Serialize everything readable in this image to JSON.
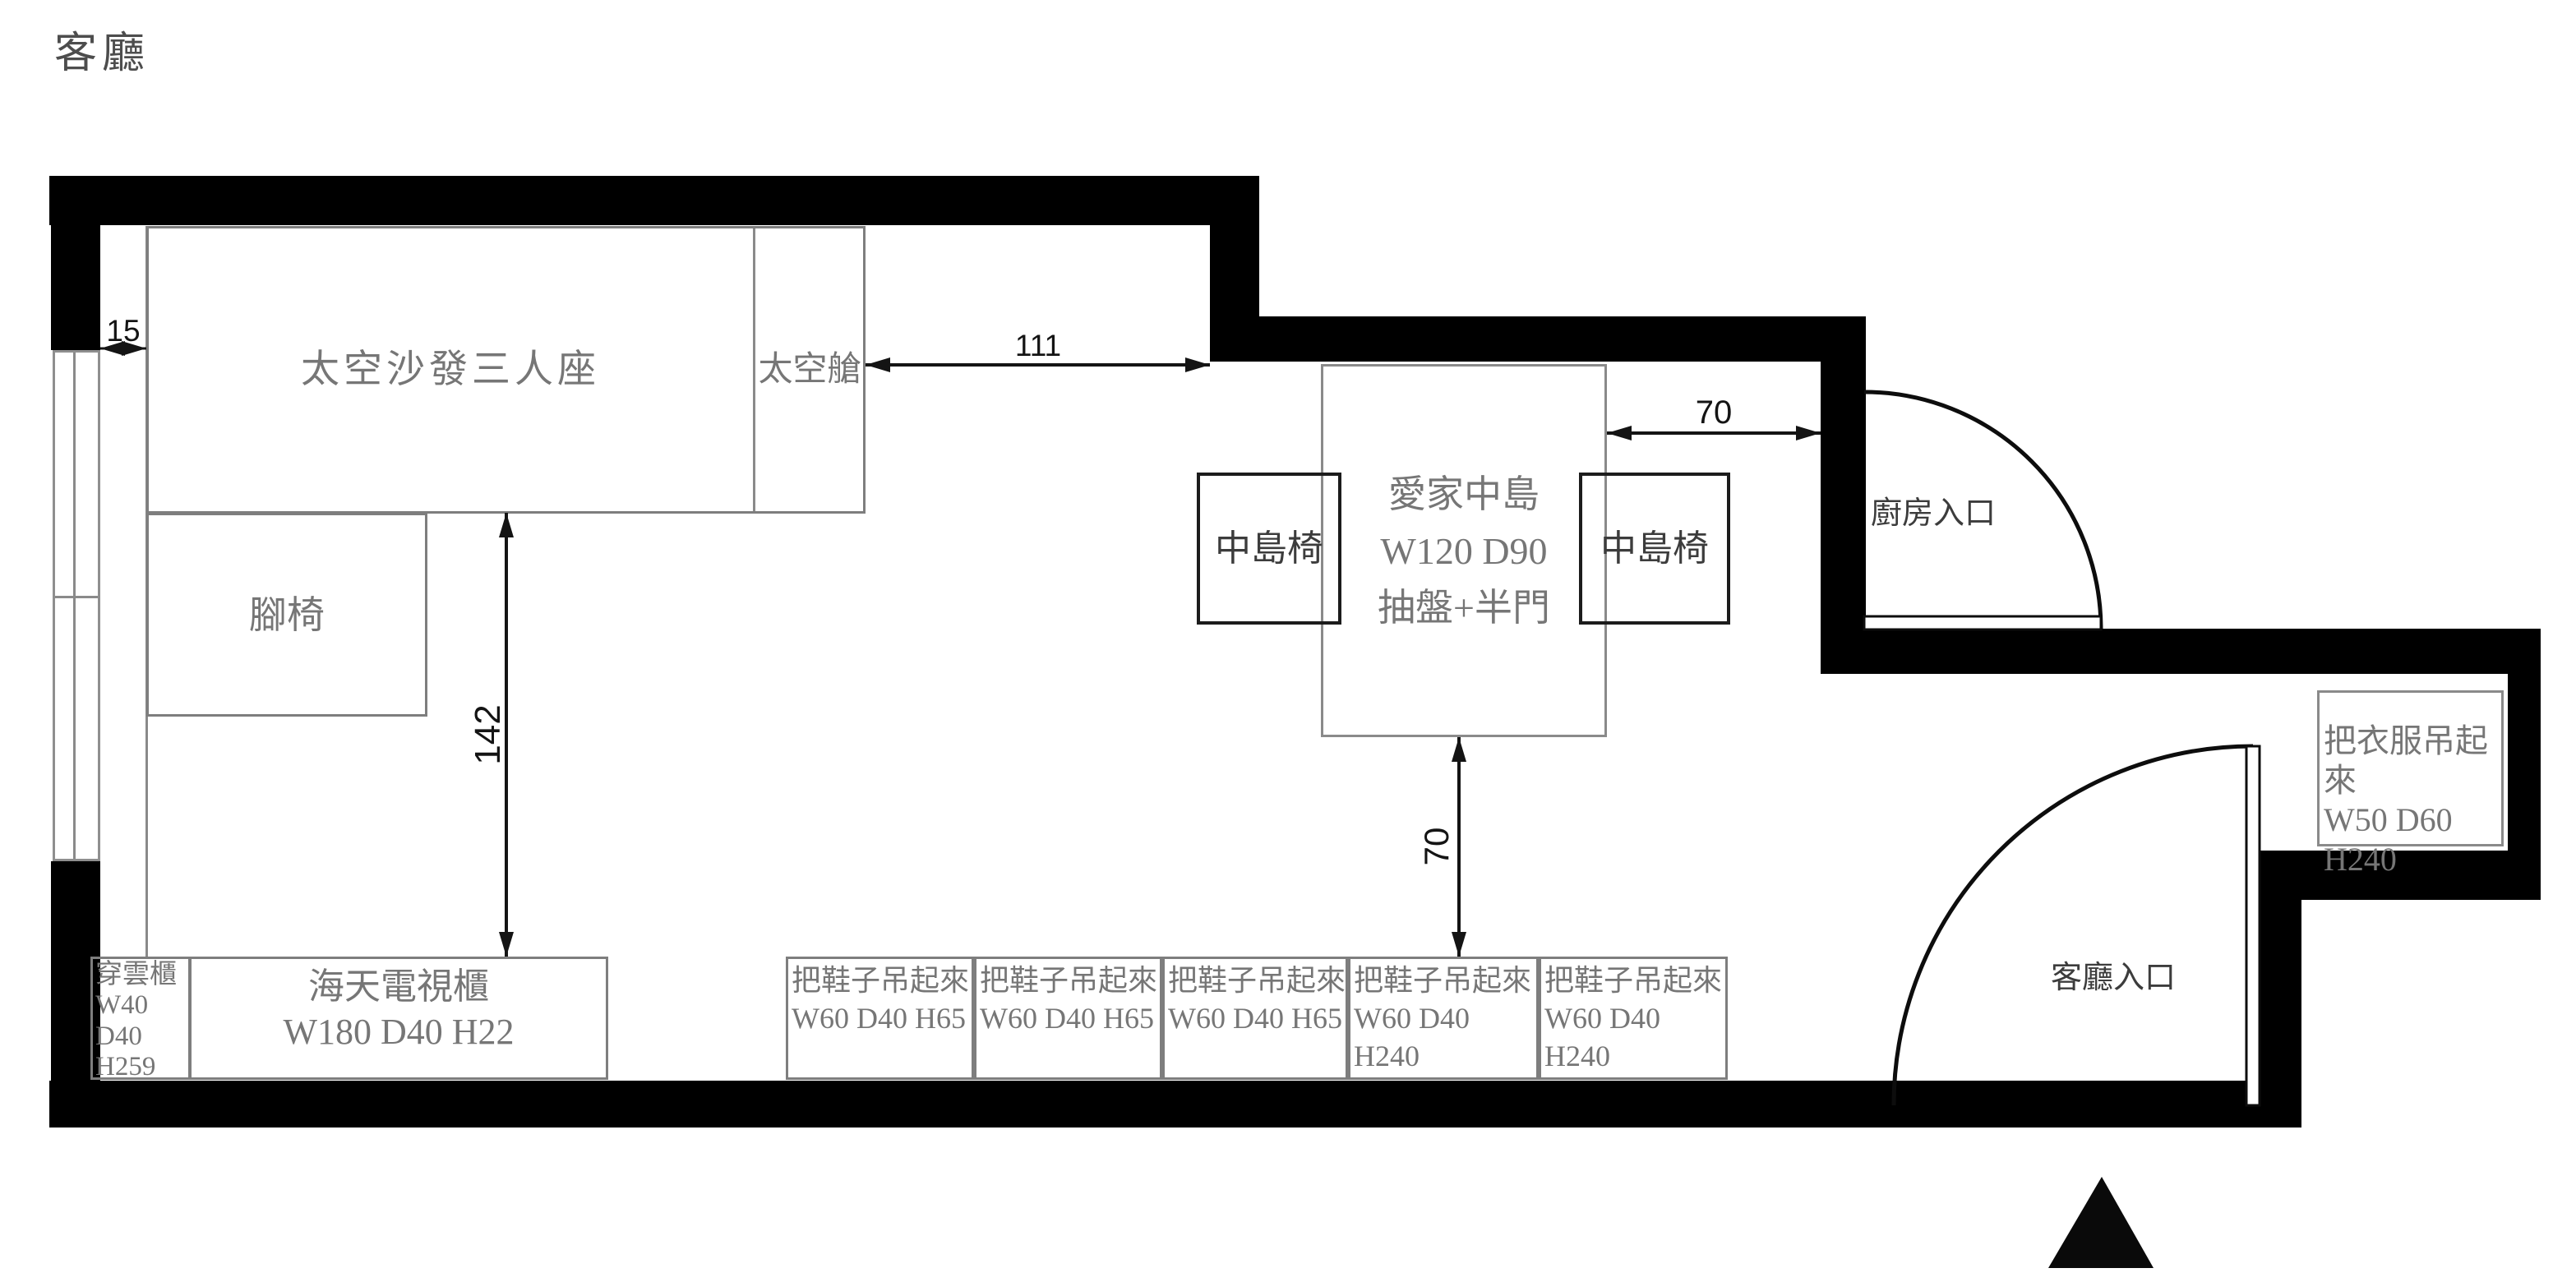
{
  "title": "客廳",
  "colors": {
    "wall": "#000000",
    "furniture_border": "#7e7e7e",
    "chair_border": "#1c1c1c",
    "furniture_text": "#767676",
    "dark_text": "#3c3c3c",
    "dimension": "#141414",
    "background": "#ffffff"
  },
  "furniture": {
    "sofa": "太空沙發三人座",
    "capsule": "太空艙",
    "footstool": "腳椅",
    "island": [
      "愛家中島",
      "W120 D90",
      "抽盤+半門"
    ],
    "chair": "中島椅",
    "cloud_cabinet": [
      "穿雲櫃",
      "W40",
      "D40",
      "H259"
    ],
    "tv_cabinet": [
      "海天電視櫃",
      "W180 D40 H22"
    ],
    "shoe_small": [
      "把鞋子吊起來",
      "W60 D40 H65"
    ],
    "shoe_tall": [
      "把鞋子吊起來",
      "W60 D40 H240"
    ],
    "wardrobe": [
      "把衣服吊起來",
      "W50 D60 H240"
    ]
  },
  "entrances": {
    "kitchen": "廚房入口",
    "living": "客廳入口"
  },
  "dimensions": {
    "sofa_gap": "15",
    "sofa_to_wall": "111",
    "island_to_wall": "70",
    "sofa_to_tv": "142",
    "island_to_shoe": "70"
  }
}
